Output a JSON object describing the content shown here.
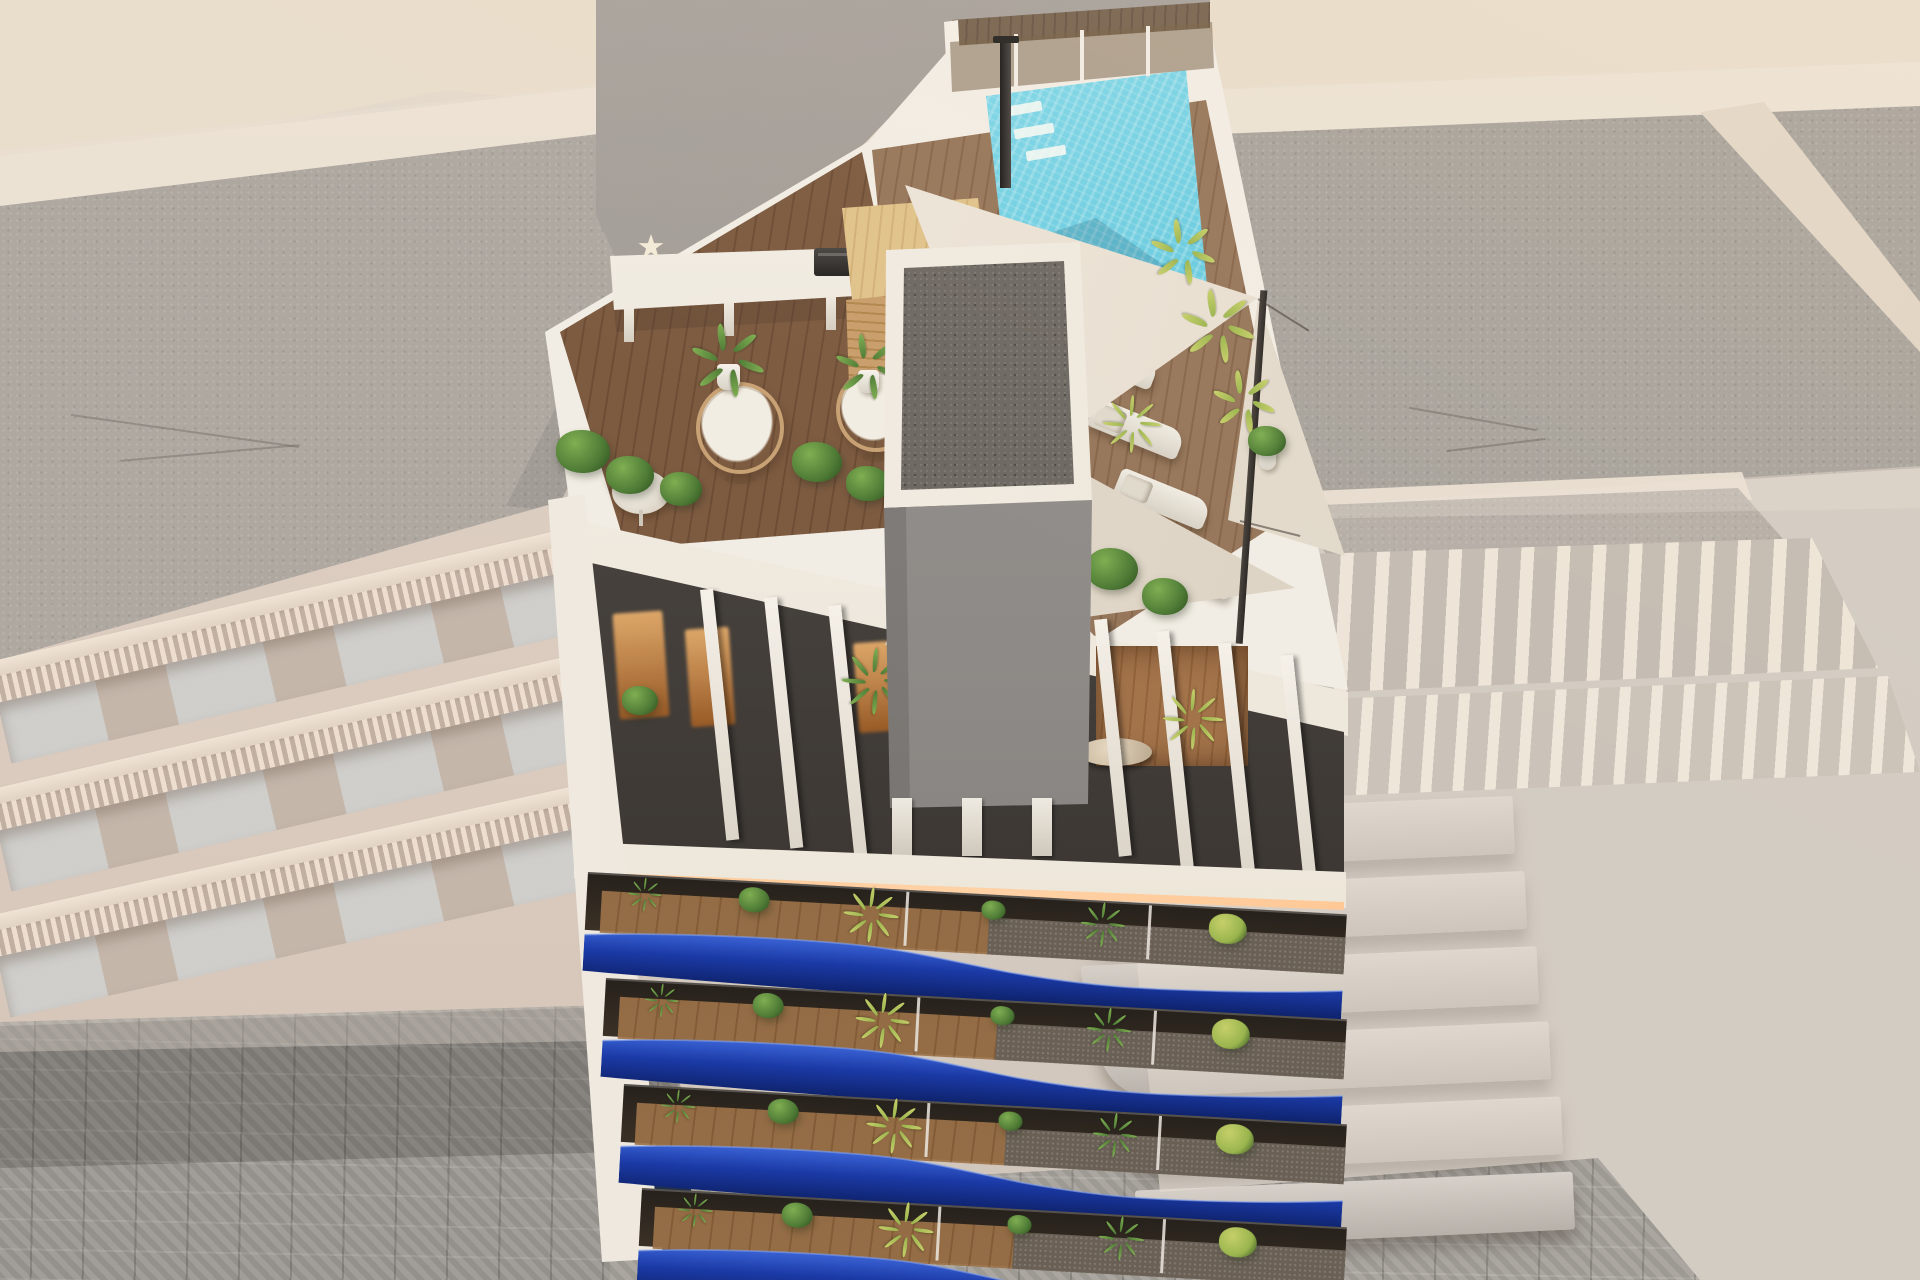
{
  "scene": {
    "title": "Aerial 3D architectural render of a modern apartment block with rooftop pool solarium and blue wave balconies, flanked by faded neighbouring buildings over a cobbled street",
    "palette": {
      "bg": "#d9cfc5",
      "bgLight": "#e7dccd",
      "road": "#e9ddcb",
      "gravel": "#8f8b86",
      "gravelDark": "#6e6963",
      "parapet": "#d9cec0",
      "parapetLight": "#f0e5d5",
      "white": "#f2ede4",
      "street": "#9c9892",
      "blue": "#16339b",
      "blueDark": "#0d2066",
      "blueLight": "#3a62d4",
      "pool": "#52c1d9",
      "led": "#ffc089",
      "green": "#4f7c36"
    },
    "rooftop": {
      "features": [
        "swimming-pool",
        "glass-pool-fence",
        "outdoor-shower",
        "timber-pool-deck",
        "bar-counter",
        "starfish-ornament",
        "barbecue-grill",
        "timber-pergola-sauna",
        "hanging-egg-chairs",
        "round-side-tables",
        "potted-palms",
        "box-hedge-planters",
        "shade-sails",
        "sail-mast",
        "sun-loungers",
        "gravel-roofed-stair-core"
      ],
      "shade_sail_count": 3,
      "egg_chair_count": 2,
      "side_table_count": 2,
      "sun_loungers": {
        "count": 4,
        "x0": 1062,
        "y0": 344,
        "dx": 26,
        "dy": 70,
        "w": 96,
        "h": 30,
        "rot": 22
      }
    },
    "pergola_fins": {
      "w": 13,
      "groups": [
        {
          "count": 3,
          "x0": 700,
          "y0": 590,
          "dx": 64,
          "dy": 8,
          "h": 252
        },
        {
          "count": 4,
          "x0": 1094,
          "y0": 620,
          "dx": 62,
          "dy": 12,
          "h": 238
        }
      ]
    },
    "glow_windows": [
      {
        "x": 616,
        "y": 612,
        "w": 50,
        "h": 106
      },
      {
        "x": 688,
        "y": 628,
        "w": 44,
        "h": 98
      },
      {
        "x": 856,
        "y": 642,
        "w": 36,
        "h": 90
      }
    ],
    "wood_room": {
      "x": 1096,
      "y": 646,
      "w": 152,
      "h": 120,
      "table": {
        "x": 1078,
        "y": 738,
        "w": 74,
        "h": 28
      }
    },
    "tower_legs": {
      "count": 3,
      "x0": 892,
      "dx": 70,
      "y": 798,
      "w": 20,
      "h": 58
    },
    "plants": [
      {
        "x": 702,
        "y": 330,
        "s": 52,
        "k": "palm",
        "pot": true
      },
      {
        "x": 845,
        "y": 340,
        "s": 46,
        "k": "palm",
        "pot": true
      },
      {
        "x": 556,
        "y": 430,
        "s": 54,
        "k": "bush"
      },
      {
        "x": 606,
        "y": 456,
        "s": 48,
        "k": "bush"
      },
      {
        "x": 660,
        "y": 472,
        "s": 42,
        "k": "bush"
      },
      {
        "x": 792,
        "y": 442,
        "s": 50,
        "k": "bush"
      },
      {
        "x": 846,
        "y": 466,
        "s": 44,
        "k": "bush"
      },
      {
        "x": 1086,
        "y": 548,
        "s": 52,
        "k": "bush"
      },
      {
        "x": 1142,
        "y": 578,
        "s": 46,
        "k": "bush"
      },
      {
        "x": 1160,
        "y": 225,
        "s": 46,
        "k": "palm",
        "tone": "y"
      },
      {
        "x": 1192,
        "y": 296,
        "s": 52,
        "k": "palm",
        "tone": "y"
      },
      {
        "x": 1222,
        "y": 376,
        "s": 44,
        "k": "palm",
        "tone": "y"
      },
      {
        "x": 1112,
        "y": 402,
        "s": 40,
        "k": "fern",
        "tone": "y"
      },
      {
        "x": 1248,
        "y": 426,
        "s": 38,
        "k": "bush",
        "pot": true
      },
      {
        "x": 852,
        "y": 656,
        "s": 46,
        "k": "fern"
      },
      {
        "x": 992,
        "y": 638,
        "s": 40,
        "k": "bush"
      },
      {
        "x": 622,
        "y": 686,
        "s": 36,
        "k": "bush"
      },
      {
        "x": 1172,
        "y": 696,
        "s": 42,
        "k": "fern",
        "tone": "y"
      }
    ],
    "balconies": {
      "count": 4,
      "tilt": 3.2,
      "divider_fr": [
        0.42,
        0.74
      ],
      "plant_fr": [
        0.06,
        0.2,
        0.35,
        0.52,
        0.66,
        0.82
      ],
      "bands": [
        {
          "l": 588,
          "t": 872,
          "w": 760
        },
        {
          "l": 606,
          "t": 978,
          "w": 742
        },
        {
          "l": 624,
          "t": 1084,
          "w": 724
        },
        {
          "l": 642,
          "t": 1188,
          "w": 706
        }
      ]
    },
    "neighbors": {
      "left": {
        "style": "balustrade-balconies",
        "rows": [
          {
            "top": 662,
            "rot": -13
          },
          {
            "top": 790,
            "rot": -13
          },
          {
            "top": 916,
            "rot": -12.5
          }
        ]
      },
      "right": {
        "style": "curved-slab-balconies",
        "slabs": {
          "count": 6,
          "x0": 1046,
          "y0": 806,
          "dx": 18,
          "dy": 75,
          "w": 468,
          "h": 58
        }
      }
    },
    "street": "cobblestone-paving",
    "lighting": "warm-led-strip-under-pergola-beam"
  }
}
